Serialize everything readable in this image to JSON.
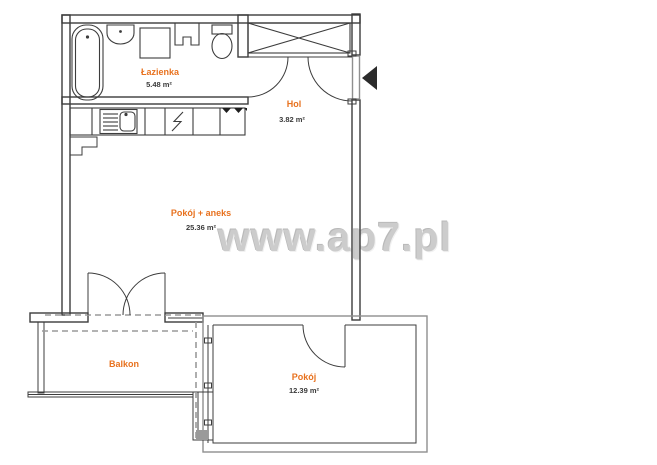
{
  "watermark": {
    "text": "www.ap7.pl",
    "color": "#cccccc"
  },
  "rooms": {
    "bathroom": {
      "name": "Łazienka",
      "area": "5.48 m²"
    },
    "hall": {
      "name": "Hol",
      "area": "3.82 m²"
    },
    "living": {
      "name": "Pokój + aneks",
      "area": "25.36 m²"
    },
    "balcony": {
      "name": "Balkon"
    },
    "bedroom": {
      "name": "Pokój",
      "area": "12.39 m²"
    }
  },
  "colors": {
    "room_label": "#e8721f",
    "area_text": "#3a3a3a",
    "wall_dark": "#3c3c3c",
    "wall_gray": "#8f8f8f",
    "overhang_dash": "#9a9a9a",
    "entrance_arrow": "#2b2b2b",
    "watermark": "#cccccc"
  },
  "icons": {
    "bathtub": "bathtub-icon",
    "washbasin": "washbasin-icon",
    "shower_unit": "shower-unit-icon",
    "duct": "duct-icon",
    "toilet": "toilet-icon",
    "kitchen_sink": "kitchen-sink-icon",
    "stove": "stove-lightning-icon",
    "hob_marks": "hob-marks-icon",
    "wardrobe": "wardrobe-x-icon",
    "entrance": "entrance-arrow-icon"
  }
}
